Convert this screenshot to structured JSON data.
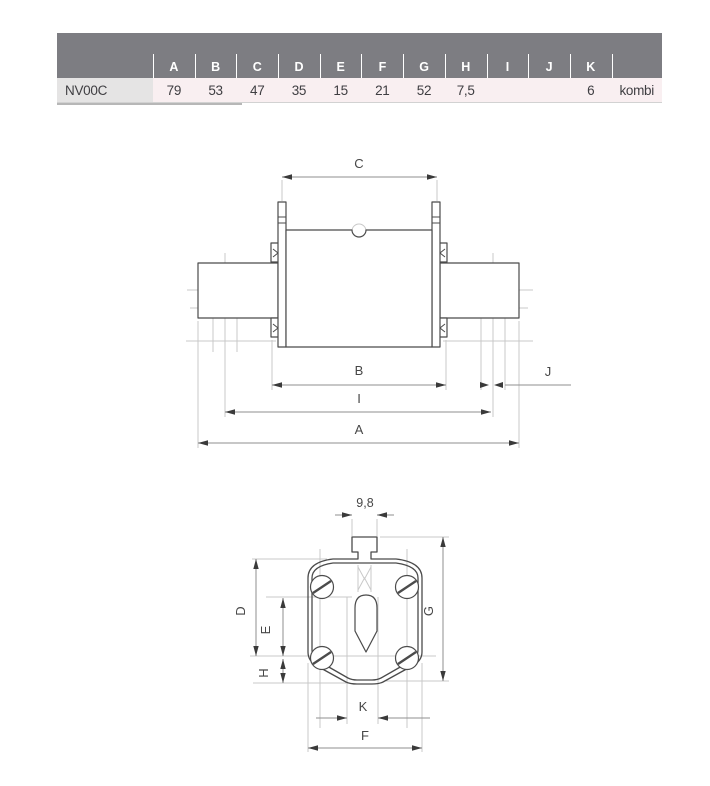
{
  "table": {
    "row_label": "NV00C",
    "columns": [
      "A",
      "B",
      "C",
      "D",
      "E",
      "F",
      "G",
      "H",
      "I",
      "J",
      "K",
      ""
    ],
    "values": [
      "79",
      "53",
      "47",
      "35",
      "15",
      "21",
      "52",
      "7,5",
      "",
      "",
      "6",
      "kombi"
    ]
  },
  "side_view": {
    "dim_c": "C",
    "dim_b": "B",
    "dim_j": "J",
    "dim_i": "I",
    "dim_a": "A"
  },
  "front_view": {
    "dim_width": "9,8",
    "dim_d": "D",
    "dim_e": "E",
    "dim_h": "H",
    "dim_g": "G",
    "dim_k": "K",
    "dim_f": "F"
  },
  "colors": {
    "header_bg": "#7d7d82",
    "row_bg": "#f9eff1",
    "label_cell_bg": "#e5e4e4",
    "outline": "#4b4b4b",
    "construction": "#c9c9c9",
    "dimension_line": "#8f8f8f"
  }
}
